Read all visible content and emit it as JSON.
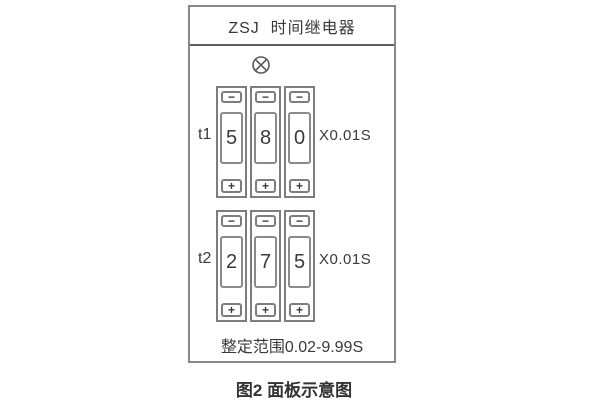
{
  "panel": {
    "title": "ZSJ  时间继电器",
    "timer_rows": [
      {
        "label": "t1",
        "digits": [
          "5",
          "8",
          "0"
        ],
        "unit": "X0.01S"
      },
      {
        "label": "t2",
        "digits": [
          "2",
          "7",
          "5"
        ],
        "unit": "X0.01S"
      }
    ],
    "button_labels": {
      "decrement": "−",
      "increment": "+"
    },
    "range_text": "整定范围0.02-9.99S"
  },
  "caption": "图2 面板示意图",
  "icons": {
    "lamp": "indicator-lamp"
  },
  "colors": {
    "background": "#ffffff",
    "panel_border": "#878787",
    "header_divider": "#5f5f5f",
    "control_border": "#7d7d7d",
    "text": "#3a3a3a"
  }
}
